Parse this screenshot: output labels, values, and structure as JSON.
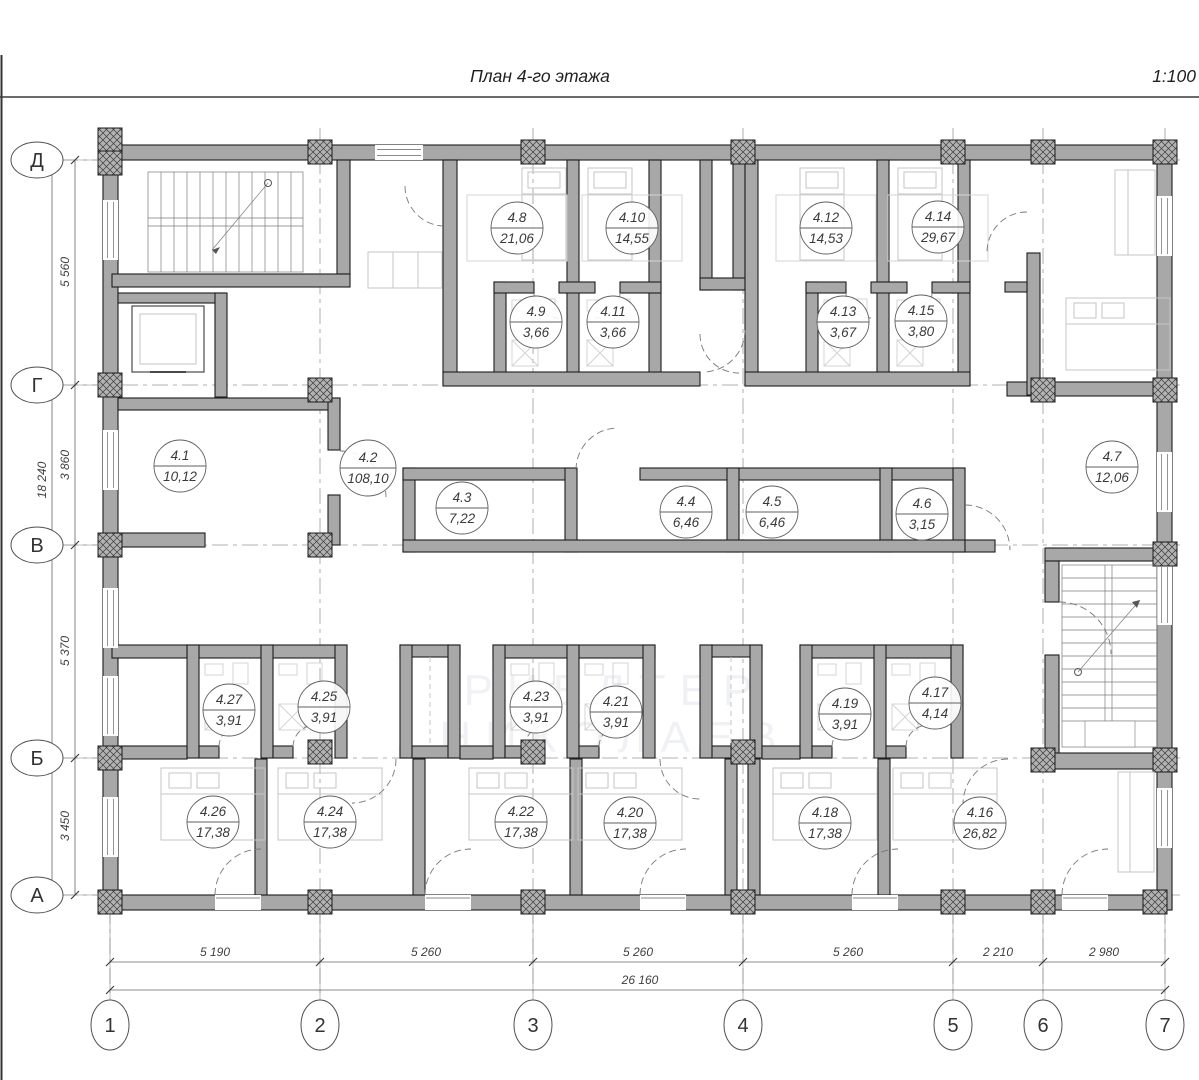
{
  "title": "План 4-го этажа",
  "scale": "1:100",
  "watermark": {
    "line1": "РИЕЛТЕР",
    "line2": "НИКОЛАЕВ"
  },
  "axes": {
    "rows": [
      "Д",
      "Г",
      "В",
      "Б",
      "А"
    ],
    "cols": [
      "1",
      "2",
      "3",
      "4",
      "5",
      "6",
      "7"
    ]
  },
  "dimensions": {
    "left_segments": [
      "5 560",
      "3 860",
      "5 370",
      "3 450"
    ],
    "left_total": "18 240",
    "bottom_segments": [
      "5 190",
      "5 260",
      "5 260",
      "5 260",
      "2 210",
      "2 980"
    ],
    "bottom_total": "26 160"
  },
  "rooms": [
    {
      "number": "4.1",
      "area": "10,12"
    },
    {
      "number": "4.2",
      "area": "108,10"
    },
    {
      "number": "4.3",
      "area": "7,22"
    },
    {
      "number": "4.4",
      "area": "6,46"
    },
    {
      "number": "4.5",
      "area": "6,46"
    },
    {
      "number": "4.6",
      "area": "3,15"
    },
    {
      "number": "4.7",
      "area": "12,06"
    },
    {
      "number": "4.8",
      "area": "21,06"
    },
    {
      "number": "4.9",
      "area": "3,66"
    },
    {
      "number": "4.10",
      "area": "14,55"
    },
    {
      "number": "4.11",
      "area": "3,66"
    },
    {
      "number": "4.12",
      "area": "14,53"
    },
    {
      "number": "4.13",
      "area": "3,67"
    },
    {
      "number": "4.14",
      "area": "29,67"
    },
    {
      "number": "4.15",
      "area": "3,80"
    },
    {
      "number": "4.16",
      "area": "26,82"
    },
    {
      "number": "4.17",
      "area": "4,14"
    },
    {
      "number": "4.18",
      "area": "17,38"
    },
    {
      "number": "4.19",
      "area": "3,91"
    },
    {
      "number": "4.20",
      "area": "17,38"
    },
    {
      "number": "4.21",
      "area": "3,91"
    },
    {
      "number": "4.22",
      "area": "17,38"
    },
    {
      "number": "4.23",
      "area": "3,91"
    },
    {
      "number": "4.24",
      "area": "17,38"
    },
    {
      "number": "4.25",
      "area": "3,91"
    },
    {
      "number": "4.26",
      "area": "17,38"
    },
    {
      "number": "4.27",
      "area": "3,91"
    }
  ]
}
